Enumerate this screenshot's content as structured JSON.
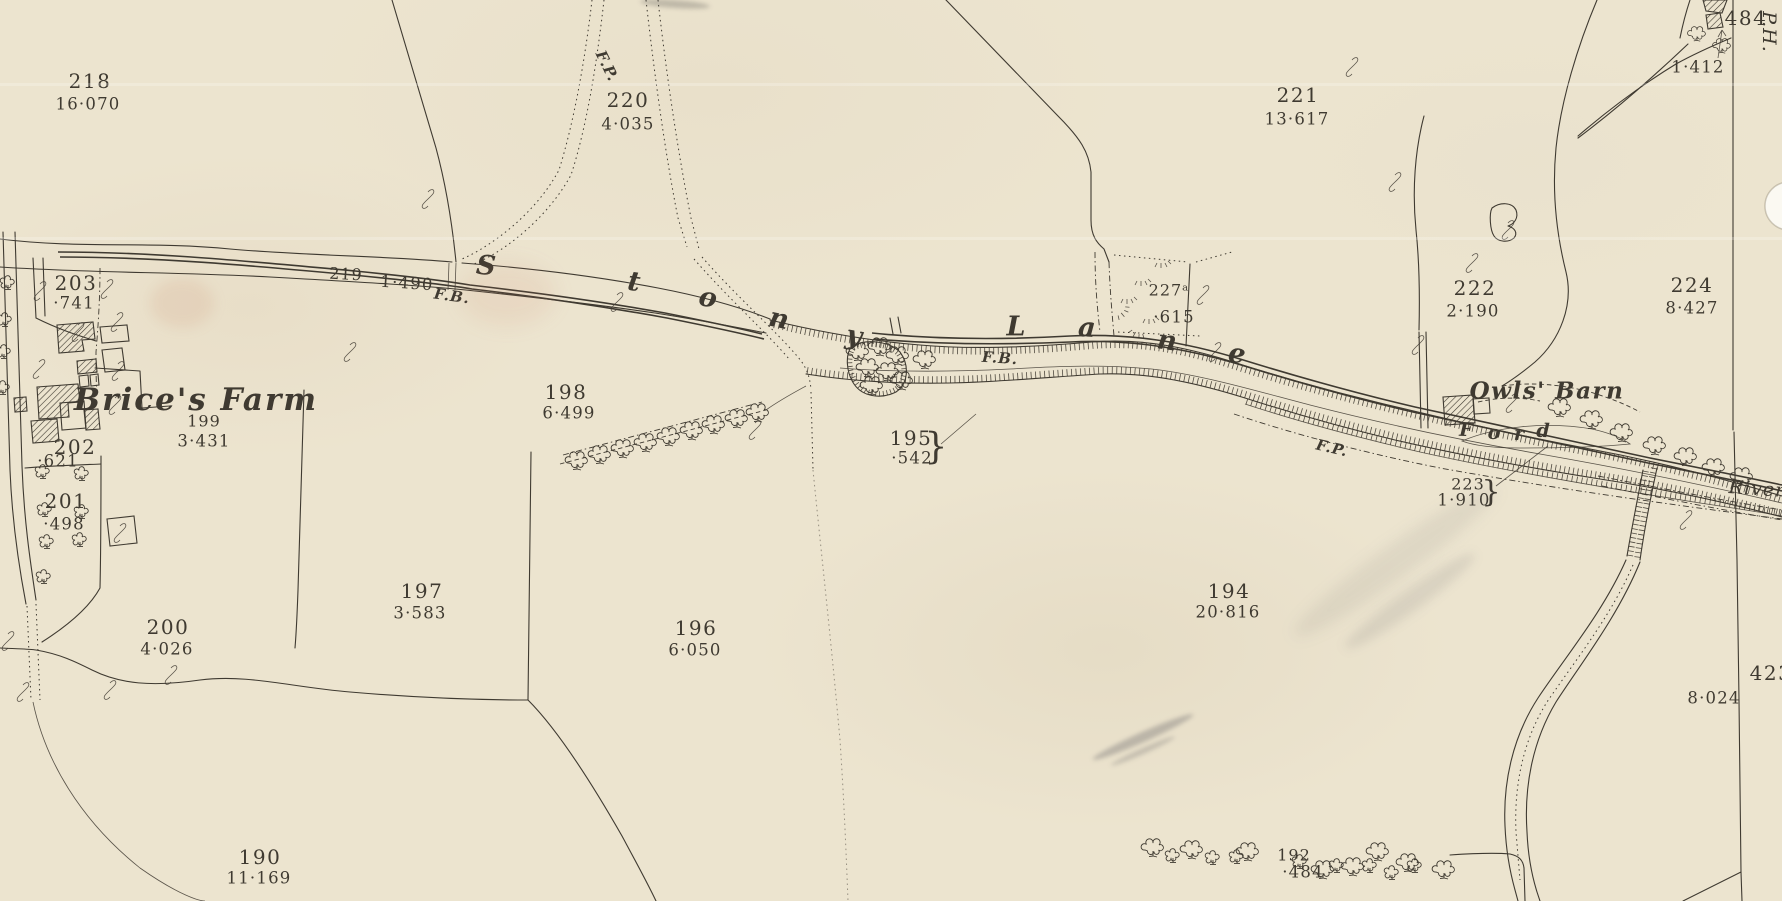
{
  "map": {
    "palette": {
      "paper": "#ece4cf",
      "ink": "#3f3a31"
    },
    "labels": [
      {
        "name": "parcel-218-number",
        "text": "218",
        "x": 90,
        "y": 81,
        "cls": "num",
        "rot": 0
      },
      {
        "name": "parcel-218-area",
        "text": "16·070",
        "x": 88,
        "y": 104,
        "cls": "area",
        "rot": 0
      },
      {
        "name": "parcel-220-number",
        "text": "220",
        "x": 628,
        "y": 100,
        "cls": "num",
        "rot": 0
      },
      {
        "name": "parcel-220-area",
        "text": "4·035",
        "x": 628,
        "y": 124,
        "cls": "area",
        "rot": 0
      },
      {
        "name": "footpath-label-top",
        "text": "F.P.",
        "x": 607,
        "y": 66,
        "cls": "fp",
        "rot": 64
      },
      {
        "name": "parcel-221-number",
        "text": "221",
        "x": 1298,
        "y": 95,
        "cls": "num",
        "rot": 0
      },
      {
        "name": "parcel-221-area",
        "text": "13·617",
        "x": 1297,
        "y": 119,
        "cls": "area",
        "rot": 0
      },
      {
        "name": "parcel-484-number",
        "text": "484",
        "x": 1746,
        "y": 18,
        "cls": "num",
        "rot": 0
      },
      {
        "name": "public-house-label",
        "text": "P.H.",
        "x": 1769,
        "y": 32,
        "cls": "vert",
        "rot": 90
      },
      {
        "name": "parcel-1412-area",
        "text": "1·412",
        "x": 1698,
        "y": 67,
        "cls": "area",
        "rot": 0
      },
      {
        "name": "parcel-203-number",
        "text": "203",
        "x": 76,
        "y": 283,
        "cls": "num",
        "rot": 0
      },
      {
        "name": "parcel-203-area",
        "text": "·741",
        "x": 74,
        "y": 303,
        "cls": "area",
        "rot": 0
      },
      {
        "name": "parcel-219-number",
        "text": "219",
        "x": 346,
        "y": 274,
        "cls": "numsm",
        "rot": 3
      },
      {
        "name": "parcel-219-area",
        "text": "1·490",
        "x": 407,
        "y": 283,
        "cls": "area",
        "rot": 4
      },
      {
        "name": "footbridge-label-west",
        "text": "F.B.",
        "x": 452,
        "y": 296,
        "cls": "fp",
        "rot": 8
      },
      {
        "name": "stony-letter-s",
        "text": "S",
        "x": 486,
        "y": 266,
        "cls": "rl",
        "rot": 5
      },
      {
        "name": "stony-letter-t",
        "text": "t",
        "x": 634,
        "y": 282,
        "cls": "rl",
        "rot": 8
      },
      {
        "name": "stony-letter-o",
        "text": "o",
        "x": 708,
        "y": 298,
        "cls": "rl",
        "rot": 10
      },
      {
        "name": "stony-letter-n",
        "text": "n",
        "x": 779,
        "y": 319,
        "cls": "rl",
        "rot": 12
      },
      {
        "name": "stony-letter-y",
        "text": "y",
        "x": 854,
        "y": 336,
        "cls": "rl",
        "rot": 10
      },
      {
        "name": "lane-letter-l",
        "text": "L",
        "x": 1016,
        "y": 327,
        "cls": "rl",
        "rot": 0
      },
      {
        "name": "lane-letter-a",
        "text": "a",
        "x": 1087,
        "y": 328,
        "cls": "rl",
        "rot": 4
      },
      {
        "name": "lane-letter-n",
        "text": "n",
        "x": 1167,
        "y": 341,
        "cls": "rl",
        "rot": 8
      },
      {
        "name": "lane-letter-e",
        "text": "e",
        "x": 1237,
        "y": 354,
        "cls": "rl",
        "rot": 8
      },
      {
        "name": "footbridge-label-mid",
        "text": "F.B.",
        "x": 1000,
        "y": 358,
        "cls": "fp",
        "rot": 4
      },
      {
        "name": "parcel-227a-number",
        "text": "227ᵃ",
        "x": 1169,
        "y": 290,
        "cls": "numsm",
        "rot": 0
      },
      {
        "name": "parcel-227a-area",
        "text": "·615",
        "x": 1174,
        "y": 317,
        "cls": "area",
        "rot": 0
      },
      {
        "name": "parcel-222-number",
        "text": "222",
        "x": 1475,
        "y": 288,
        "cls": "num",
        "rot": 0
      },
      {
        "name": "parcel-222-area",
        "text": "2·190",
        "x": 1473,
        "y": 311,
        "cls": "area",
        "rot": 0
      },
      {
        "name": "parcel-224-number",
        "text": "224",
        "x": 1692,
        "y": 285,
        "cls": "num",
        "rot": 0
      },
      {
        "name": "parcel-224-area",
        "text": "8·427",
        "x": 1692,
        "y": 308,
        "cls": "area",
        "rot": 0
      },
      {
        "name": "brices-farm-name",
        "text": "Brice's Farm",
        "x": 196,
        "y": 400,
        "cls": "namelg",
        "rot": 0
      },
      {
        "name": "parcel-199-number",
        "text": "199",
        "x": 204,
        "y": 421,
        "cls": "numsm",
        "rot": 0
      },
      {
        "name": "parcel-199-area",
        "text": "3·431",
        "x": 204,
        "y": 441,
        "cls": "area",
        "rot": 0
      },
      {
        "name": "parcel-198-number",
        "text": "198",
        "x": 566,
        "y": 392,
        "cls": "num",
        "rot": 0
      },
      {
        "name": "parcel-198-area",
        "text": "6·499",
        "x": 569,
        "y": 413,
        "cls": "area",
        "rot": 0
      },
      {
        "name": "parcel-202-number",
        "text": "202",
        "x": 75,
        "y": 447,
        "cls": "num",
        "rot": 0
      },
      {
        "name": "parcel-202-area",
        "text": "·621",
        "x": 58,
        "y": 461,
        "cls": "area",
        "rot": 0
      },
      {
        "name": "parcel-201-number",
        "text": "201",
        "x": 66,
        "y": 501,
        "cls": "num",
        "rot": 0
      },
      {
        "name": "parcel-201-area",
        "text": "·498",
        "x": 64,
        "y": 524,
        "cls": "area",
        "rot": 0
      },
      {
        "name": "parcel-195-number",
        "text": "195",
        "x": 911,
        "y": 438,
        "cls": "num",
        "rot": 0
      },
      {
        "name": "parcel-195-area",
        "text": "·542",
        "x": 912,
        "y": 458,
        "cls": "area",
        "rot": 0
      },
      {
        "name": "parcel-195-brace",
        "text": "}",
        "x": 936,
        "y": 447,
        "cls": "brace",
        "rot": 0
      },
      {
        "name": "parcel-200-number",
        "text": "200",
        "x": 168,
        "y": 627,
        "cls": "num",
        "rot": 0
      },
      {
        "name": "parcel-200-area",
        "text": "4·026",
        "x": 167,
        "y": 649,
        "cls": "area",
        "rot": 0
      },
      {
        "name": "parcel-197-number",
        "text": "197",
        "x": 422,
        "y": 591,
        "cls": "num",
        "rot": 0
      },
      {
        "name": "parcel-197-area",
        "text": "3·583",
        "x": 420,
        "y": 613,
        "cls": "area",
        "rot": 0
      },
      {
        "name": "parcel-196-number",
        "text": "196",
        "x": 696,
        "y": 628,
        "cls": "num",
        "rot": 0
      },
      {
        "name": "parcel-196-area",
        "text": "6·050",
        "x": 695,
        "y": 650,
        "cls": "area",
        "rot": 0
      },
      {
        "name": "parcel-194-number",
        "text": "194",
        "x": 1229,
        "y": 591,
        "cls": "num",
        "rot": 0
      },
      {
        "name": "parcel-194-area",
        "text": "20·816",
        "x": 1228,
        "y": 612,
        "cls": "area",
        "rot": 0
      },
      {
        "name": "owls-barn-name",
        "text": "Owls' Barn",
        "x": 1547,
        "y": 391,
        "cls": "namemd",
        "rot": 0
      },
      {
        "name": "ford-letter-f",
        "text": "F",
        "x": 1466,
        "y": 430,
        "cls": "fl",
        "rot": 2
      },
      {
        "name": "ford-letter-o",
        "text": "o",
        "x": 1494,
        "y": 433,
        "cls": "fl",
        "rot": 2
      },
      {
        "name": "ford-letter-r",
        "text": "r",
        "x": 1519,
        "y": 434,
        "cls": "fl",
        "rot": 2
      },
      {
        "name": "ford-letter-d",
        "text": "d",
        "x": 1543,
        "y": 431,
        "cls": "fl",
        "rot": 2
      },
      {
        "name": "footpath-label-mid",
        "text": "F.P.",
        "x": 1332,
        "y": 448,
        "cls": "fp",
        "rot": 13
      },
      {
        "name": "parcel-223-number",
        "text": "223",
        "x": 1468,
        "y": 484,
        "cls": "numsm",
        "rot": 0
      },
      {
        "name": "parcel-223-area",
        "text": "1·910",
        "x": 1464,
        "y": 500,
        "cls": "area",
        "rot": 0
      },
      {
        "name": "parcel-223-brace",
        "text": "}",
        "x": 1491,
        "y": 492,
        "cls": "bracesm",
        "rot": 0
      },
      {
        "name": "river-label",
        "text": "River",
        "x": 1757,
        "y": 489,
        "cls": "river",
        "rot": 4
      },
      {
        "name": "parcel-192-number",
        "text": "192",
        "x": 1294,
        "y": 855,
        "cls": "numsm",
        "rot": 0
      },
      {
        "name": "parcel-192-area",
        "text": "·484",
        "x": 1303,
        "y": 872,
        "cls": "area",
        "rot": 0
      },
      {
        "name": "parcel-190-number",
        "text": "190",
        "x": 260,
        "y": 857,
        "cls": "num",
        "rot": 0
      },
      {
        "name": "parcel-190-area",
        "text": "11·169",
        "x": 259,
        "y": 878,
        "cls": "area",
        "rot": 0
      },
      {
        "name": "parcel-423-number",
        "text": "423",
        "x": 1771,
        "y": 673,
        "cls": "num",
        "rot": 0
      },
      {
        "name": "parcel-8024-area",
        "text": "8·024",
        "x": 1714,
        "y": 698,
        "cls": "area",
        "rot": 0
      }
    ]
  }
}
